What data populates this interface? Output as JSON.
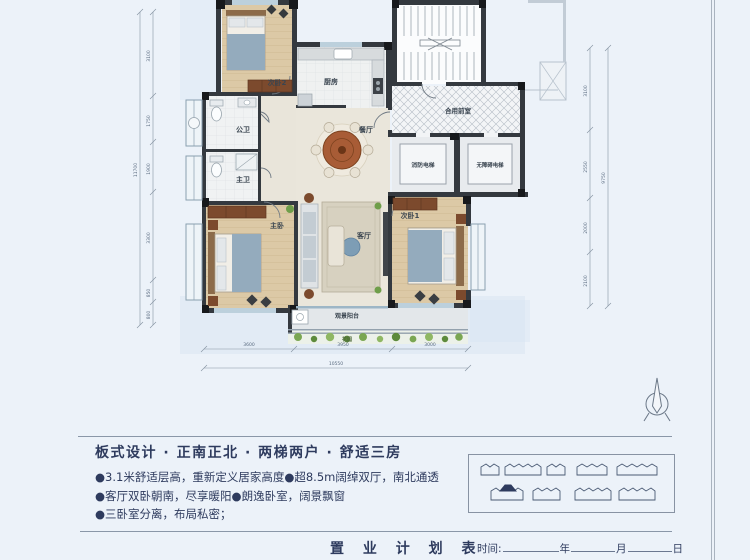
{
  "colors": {
    "background": "#ecf2f9",
    "wall": "#34393f",
    "wood_floor": "#dcc9a6",
    "accent_navy": "#2e3b5e",
    "garden_green": "#6f9e4a"
  },
  "plan": {
    "rooms": {
      "bedroom2": "次卧2",
      "kitchen": "厨房",
      "bath_public": "公卫",
      "bath_master": "主卫",
      "master": "主卧",
      "dining": "餐厅",
      "living": "客厅",
      "bedroom1": "次卧1",
      "lobby": "合用前室",
      "elevator_fire": "消防电梯",
      "elevator_barrier_free": "无障碍电梯",
      "balcony": "观景阳台",
      "garden": "花园"
    },
    "dims": {
      "left": [
        "3100",
        "1750",
        "1900",
        "3300",
        "850",
        "800"
      ],
      "left_total": "11700",
      "bottom": [
        "3600",
        "3950",
        "3000"
      ],
      "bottom_total": "10550",
      "right": [
        "3100",
        "2550",
        "2000",
        "2100"
      ],
      "right_total": "9750"
    }
  },
  "info": {
    "title": "板式设计 · 正南正北 · 两梯两户 · 舒适三房",
    "bullets": [
      "●3.1米舒适层高，重新定义居家高度●超8.5m阔绰双厅，南北通透",
      "●客厅双卧朝南，尽享暖阳●朗逸卧室，阔景飘窗",
      "●三卧室分离，布局私密；"
    ]
  },
  "footer": {
    "table_title": "置 业 计 划 表",
    "time_label": "时间:",
    "year": "年",
    "month": "月",
    "day": "日"
  }
}
